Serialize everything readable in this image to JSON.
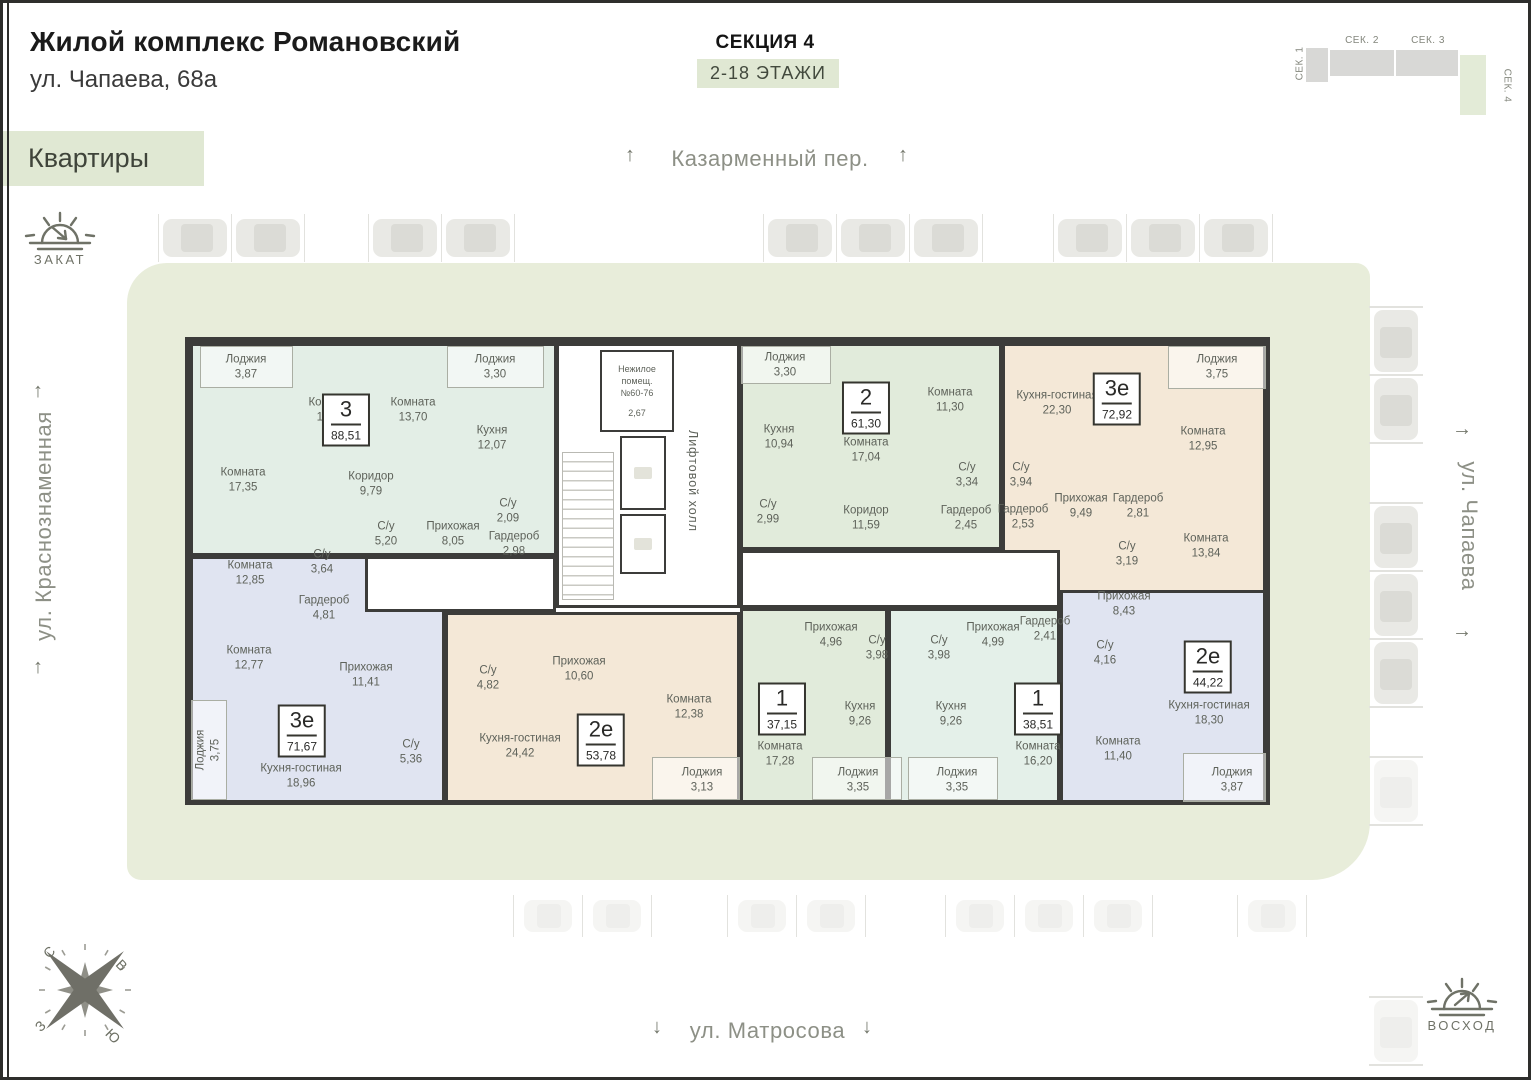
{
  "header": {
    "title": "Жилой комплекс Романовский",
    "address": "ул. Чапаева, 68а",
    "nav_label": "Квартиры",
    "section_title": "СЕКЦИЯ 4",
    "floors_badge": "2-18 ЭТАЖИ"
  },
  "minimap": {
    "sections": [
      {
        "label": "СЕК. 1",
        "active": false
      },
      {
        "label": "СЕК. 2",
        "active": false
      },
      {
        "label": "СЕК. 3",
        "active": false
      },
      {
        "label": "СЕК. 4",
        "active": true
      }
    ]
  },
  "streets": {
    "top": "Казарменный пер.",
    "left": "ул. Краснознаменная",
    "right": "ул. Чапаева",
    "bottom": "ул. Матросова"
  },
  "markers": {
    "sunset": "ЗАКАТ",
    "sunrise": "ВОСХОД"
  },
  "compass": {
    "north": "С",
    "east": "В",
    "west": "З",
    "south": "Ю"
  },
  "icons": {
    "arrow_up": "↑",
    "arrow_down": "↓",
    "arrow_right": "→"
  },
  "core": {
    "non_residential": [
      "Нежилое",
      "помещ.",
      "№60-76",
      "2,67"
    ],
    "lift_hall": "Лифтовой холл"
  },
  "plan": {
    "wall_color": "#3c3c3a",
    "white_areas": [
      {
        "x": 556,
        "y": 343,
        "w": 184,
        "h": 265
      },
      {
        "x": 365,
        "y": 556,
        "w": 191,
        "h": 56
      },
      {
        "x": 740,
        "y": 550,
        "w": 320,
        "h": 58
      }
    ],
    "apartments": [
      {
        "type": "3",
        "area": "88,51",
        "color": "#e3eee6",
        "block": {
          "x": 190,
          "y": 343,
          "w": 367,
          "h": 213
        },
        "badge": {
          "x": 346,
          "y": 420
        },
        "rooms": [
          {
            "n": "Лоджия",
            "a": "3,87",
            "x": 246,
            "y": 367,
            "strip": {
              "x": 200,
              "y": 346,
              "w": 93,
              "h": 42
            }
          },
          {
            "n": "Комната",
            "a": "13,70",
            "x": 331,
            "y": 410
          },
          {
            "n": "Комната",
            "a": "13,70",
            "x": 413,
            "y": 410
          },
          {
            "n": "Лоджия",
            "a": "3,30",
            "x": 495,
            "y": 367,
            "strip": {
              "x": 447,
              "y": 346,
              "w": 97,
              "h": 42
            }
          },
          {
            "n": "Кухня",
            "a": "12,07",
            "x": 492,
            "y": 438
          },
          {
            "n": "Комната",
            "a": "17,35",
            "x": 243,
            "y": 480
          },
          {
            "n": "Коридор",
            "a": "9,79",
            "x": 371,
            "y": 484
          },
          {
            "n": "С/у",
            "a": "5,20",
            "x": 386,
            "y": 534
          },
          {
            "n": "Прихожая",
            "a": "8,05",
            "x": 453,
            "y": 534
          },
          {
            "n": "С/у",
            "a": "2,09",
            "x": 508,
            "y": 511
          },
          {
            "n": "Гардероб",
            "a": "2,98",
            "x": 514,
            "y": 544
          }
        ]
      },
      {
        "type": "2",
        "area": "61,30",
        "color": "#e1ebdb",
        "block": {
          "x": 740,
          "y": 343,
          "w": 262,
          "h": 207
        },
        "badge": {
          "x": 866,
          "y": 408
        },
        "rooms": [
          {
            "n": "Лоджия",
            "a": "3,30",
            "x": 785,
            "y": 365,
            "strip": {
              "x": 741,
              "y": 346,
              "w": 90,
              "h": 38
            }
          },
          {
            "n": "Кухня",
            "a": "10,94",
            "x": 779,
            "y": 437
          },
          {
            "n": "Комната",
            "a": "17,04",
            "x": 866,
            "y": 450
          },
          {
            "n": "Комната",
            "a": "11,30",
            "x": 950,
            "y": 400
          },
          {
            "n": "С/у",
            "a": "3,34",
            "x": 967,
            "y": 475
          },
          {
            "n": "С/у",
            "a": "2,99",
            "x": 768,
            "y": 512
          },
          {
            "n": "Коридор",
            "a": "11,59",
            "x": 866,
            "y": 518
          },
          {
            "n": "Гардероб",
            "a": "2,45",
            "x": 966,
            "y": 518
          }
        ]
      },
      {
        "type": "3е",
        "area": "72,92",
        "color": "#f4e8d7",
        "block": {
          "x": 1002,
          "y": 343,
          "w": 264,
          "h": 260
        },
        "badge": {
          "x": 1117,
          "y": 399
        },
        "rooms": [
          {
            "n": "Кухня-гостиная",
            "a": "22,30",
            "x": 1057,
            "y": 403
          },
          {
            "n": "Лоджия",
            "a": "3,75",
            "x": 1217,
            "y": 367,
            "strip": {
              "x": 1168,
              "y": 346,
              "w": 98,
              "h": 43
            }
          },
          {
            "n": "Комната",
            "a": "12,95",
            "x": 1203,
            "y": 439
          },
          {
            "n": "С/у",
            "a": "3,94",
            "x": 1021,
            "y": 475
          },
          {
            "n": "Гардероб",
            "a": "2,53",
            "x": 1023,
            "y": 517
          },
          {
            "n": "Прихожая",
            "a": "9,49",
            "x": 1081,
            "y": 506
          },
          {
            "n": "Гардероб",
            "a": "2,81",
            "x": 1138,
            "y": 506
          },
          {
            "n": "С/у",
            "a": "3,19",
            "x": 1127,
            "y": 554
          },
          {
            "n": "Комната",
            "a": "13,84",
            "x": 1206,
            "y": 546
          }
        ]
      },
      {
        "type": "3е",
        "area": "71,67",
        "color": "#e0e4f1",
        "block": {
          "x": 190,
          "y": 556,
          "w": 255,
          "h": 247
        },
        "badge": {
          "x": 302,
          "y": 731
        },
        "rooms": [
          {
            "n": "Комната",
            "a": "12,85",
            "x": 250,
            "y": 573
          },
          {
            "n": "С/у",
            "a": "3,64",
            "x": 322,
            "y": 562
          },
          {
            "n": "Гардероб",
            "a": "4,81",
            "x": 324,
            "y": 608
          },
          {
            "n": "Комната",
            "a": "12,77",
            "x": 249,
            "y": 658
          },
          {
            "n": "Прихожая",
            "a": "11,41",
            "x": 366,
            "y": 675
          },
          {
            "n": "Лоджия",
            "a": "3,75",
            "x": 208,
            "y": 750,
            "rot": true,
            "strip": {
              "x": 191,
              "y": 700,
              "w": 36,
              "h": 100
            }
          },
          {
            "n": "Кухня-гостиная",
            "a": "18,96",
            "x": 301,
            "y": 776
          },
          {
            "n": "С/у",
            "a": "5,36",
            "x": 411,
            "y": 752
          }
        ]
      },
      {
        "type": "2е",
        "area": "53,78",
        "color": "#f4e8d7",
        "block": {
          "x": 445,
          "y": 612,
          "w": 295,
          "h": 191
        },
        "badge": {
          "x": 601,
          "y": 740
        },
        "rooms": [
          {
            "n": "С/у",
            "a": "4,82",
            "x": 488,
            "y": 678
          },
          {
            "n": "Прихожая",
            "a": "10,60",
            "x": 579,
            "y": 669
          },
          {
            "n": "Кухня-гостиная",
            "a": "24,42",
            "x": 520,
            "y": 746
          },
          {
            "n": "Комната",
            "a": "12,38",
            "x": 689,
            "y": 707
          },
          {
            "n": "Лоджия",
            "a": "3,13",
            "x": 702,
            "y": 780,
            "strip": {
              "x": 652,
              "y": 757,
              "w": 88,
              "h": 43
            }
          }
        ]
      },
      {
        "type": "1",
        "area": "37,15",
        "color": "#e1ebdb",
        "block": {
          "x": 740,
          "y": 608,
          "w": 148,
          "h": 195
        },
        "badge": {
          "x": 782,
          "y": 709
        },
        "rooms": [
          {
            "n": "Прихожая",
            "a": "4,96",
            "x": 831,
            "y": 635
          },
          {
            "n": "С/у",
            "a": "3,98",
            "x": 877,
            "y": 648
          },
          {
            "n": "Кухня",
            "a": "9,26",
            "x": 860,
            "y": 714
          },
          {
            "n": "Комната",
            "a": "17,28",
            "x": 780,
            "y": 754
          },
          {
            "n": "Лоджия",
            "a": "3,35",
            "x": 858,
            "y": 780,
            "strip": {
              "x": 812,
              "y": 757,
              "w": 90,
              "h": 43
            }
          }
        ]
      },
      {
        "type": "1",
        "area": "38,51",
        "color": "#e4f0e9",
        "block": {
          "x": 888,
          "y": 608,
          "w": 172,
          "h": 195
        },
        "badge": {
          "x": 1038,
          "y": 709
        },
        "rooms": [
          {
            "n": "С/у",
            "a": "3,98",
            "x": 939,
            "y": 648
          },
          {
            "n": "Прихожая",
            "a": "4,99",
            "x": 993,
            "y": 635
          },
          {
            "n": "Гардероб",
            "a": "2,41",
            "x": 1045,
            "y": 629
          },
          {
            "n": "Кухня",
            "a": "9,26",
            "x": 951,
            "y": 714
          },
          {
            "n": "Комната",
            "a": "16,20",
            "x": 1038,
            "y": 754
          },
          {
            "n": "Лоджия",
            "a": "3,35",
            "x": 957,
            "y": 780,
            "strip": {
              "x": 908,
              "y": 757,
              "w": 90,
              "h": 43
            }
          }
        ]
      },
      {
        "type": "2е",
        "area": "44,22",
        "color": "#e0e4f1",
        "block": {
          "x": 1060,
          "y": 590,
          "w": 206,
          "h": 213
        },
        "badge": {
          "x": 1208,
          "y": 667
        },
        "rooms": [
          {
            "n": "Прихожая",
            "a": "8,43",
            "x": 1124,
            "y": 604
          },
          {
            "n": "С/у",
            "a": "4,16",
            "x": 1105,
            "y": 653
          },
          {
            "n": "Кухня-гостиная",
            "a": "18,30",
            "x": 1209,
            "y": 713
          },
          {
            "n": "Комната",
            "a": "11,40",
            "x": 1118,
            "y": 749
          },
          {
            "n": "Лоджия",
            "a": "3,87",
            "x": 1232,
            "y": 780,
            "strip": {
              "x": 1183,
              "y": 753,
              "w": 83,
              "h": 49
            }
          }
        ]
      }
    ]
  },
  "parking": {
    "rows": [
      {
        "name": "parking-top",
        "dir": "h",
        "y": 219,
        "car_w": 64,
        "car_h": 38,
        "gap": 9,
        "faded": false,
        "groups": [
          {
            "pos": 163,
            "n": 2
          },
          {
            "pos": 373,
            "n": 2
          },
          {
            "pos": 768,
            "n": 3
          },
          {
            "pos": 1058,
            "n": 2
          },
          {
            "pos": 1204,
            "n": 1
          }
        ]
      },
      {
        "name": "parking-bottom",
        "dir": "h",
        "y": 900,
        "car_w": 48,
        "car_h": 32,
        "gap": 21,
        "faded": true,
        "groups": [
          {
            "pos": 524,
            "n": 2
          },
          {
            "pos": 738,
            "n": 2
          },
          {
            "pos": 956,
            "n": 3
          },
          {
            "pos": 1248,
            "n": 1
          }
        ]
      },
      {
        "name": "parking-right",
        "dir": "v",
        "x": 1374,
        "car_w": 44,
        "car_h": 62,
        "gap": 6,
        "faded": false,
        "groups": [
          {
            "pos": 310,
            "n": 2
          },
          {
            "pos": 506,
            "n": 3
          },
          {
            "pos": 760,
            "n": 1,
            "faded": true
          },
          {
            "pos": 1000,
            "n": 1,
            "faded": true
          }
        ]
      }
    ]
  },
  "theme": {
    "accent_green": "#e0e8d3",
    "courtyard": "#e8edda",
    "wall": "#3c3c3a",
    "street_text": "#8d9086"
  }
}
